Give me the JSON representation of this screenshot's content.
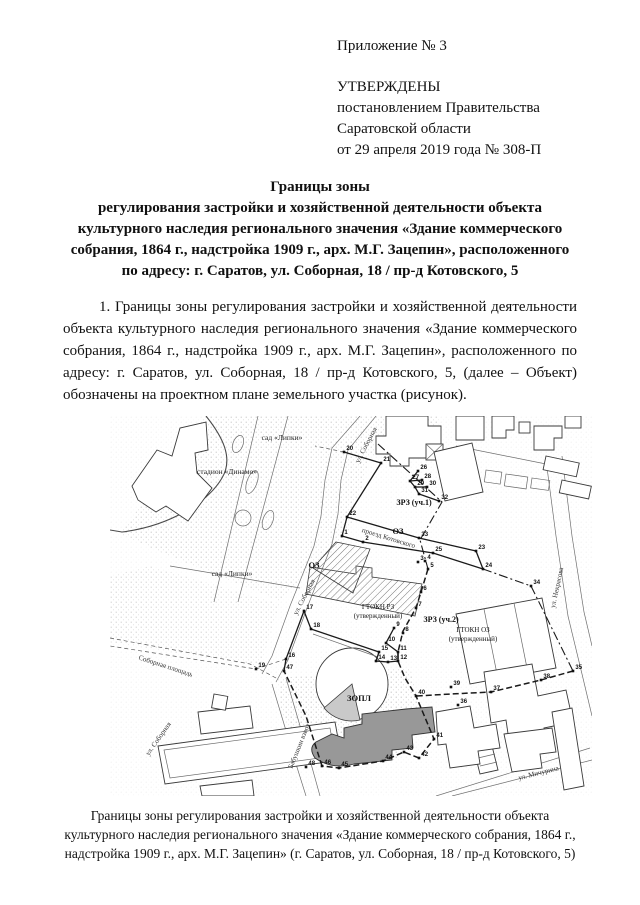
{
  "page": {
    "appendix": "Приложение № 3",
    "approval": [
      "УТВЕРЖДЕНЫ",
      "постановлением Правительства",
      "Саратовской области",
      "от 29 апреля 2019 года № 308-П"
    ],
    "title": [
      "Границы зоны",
      "регулирования застройки и хозяйственной деятельности объекта",
      "культурного наследия регионального значения «Здание коммерческого",
      "собрания, 1864 г., надстройка 1909 г., арх. М.Г. Зацепин», расположенного",
      "по адресу: г. Саратов, ул. Соборная, 18 / пр-д Котовского, 5"
    ],
    "paragraph": "1. Границы зоны регулирования застройки и хозяйственной деятельности объекта культурного наследия регионального значения «Здание коммерческого собрания, 1864 г., надстройка 1909 г., арх. М.Г. Зацепин», расположенного по адресу: г. Саратов, ул. Соборная, 18 / пр-д Котовского, 5, (далее – Объект) обозначены на проектном плане земельного участка (рисунок).",
    "caption": [
      "Границы зоны регулирования застройки и хозяйственной деятельности объекта",
      "культурного наследия регионального значения «Здание коммерческого собрания, 1864 г.,",
      "надстройка 1909 г., арх. М.Г. Зацепин» (г. Саратов, ул. Соборная, 18 / пр-д Котовского, 5)"
    ]
  },
  "map": {
    "labels": [
      {
        "t": "сад «Липки»",
        "x": 172,
        "y": 24,
        "r": 0,
        "k": "area"
      },
      {
        "t": "стадион «Динамо»",
        "x": 117,
        "y": 58,
        "r": 0,
        "k": "area"
      },
      {
        "t": "сад «Липки»",
        "x": 122,
        "y": 160,
        "r": 0,
        "k": "area"
      },
      {
        "t": "ул. Соборная",
        "x": 258,
        "y": 30,
        "r": -62,
        "k": "street"
      },
      {
        "t": "ОЗ",
        "x": 288,
        "y": 118,
        "r": 0,
        "k": "zone"
      },
      {
        "t": "ОЗ",
        "x": 204,
        "y": 152,
        "r": 0,
        "k": "zone"
      },
      {
        "t": "ЗРЗ (уч.1)",
        "x": 304,
        "y": 89,
        "r": 0,
        "k": "zone-bold"
      },
      {
        "t": "проезд Котовского",
        "x": 278,
        "y": 124,
        "r": 17,
        "k": "street"
      },
      {
        "t": "ул. Соборная",
        "x": 196,
        "y": 182,
        "r": -62,
        "k": "street"
      },
      {
        "t": "ГТОКН РЗ",
        "x": 268,
        "y": 193,
        "r": 0,
        "k": "zone-sm"
      },
      {
        "t": "(утвержденный)",
        "x": 268,
        "y": 202,
        "r": 0,
        "k": "zone-sm"
      },
      {
        "t": "ЗРЗ (уч.2)",
        "x": 331,
        "y": 206,
        "r": 0,
        "k": "zone-bold"
      },
      {
        "t": "ГТОКН ОЗ",
        "x": 363,
        "y": 216,
        "r": 0,
        "k": "zone-sm"
      },
      {
        "t": "(утвержденный)",
        "x": 363,
        "y": 225,
        "r": 0,
        "k": "zone-sm"
      },
      {
        "t": "ЗОПЛ",
        "x": 249,
        "y": 285,
        "r": 0,
        "k": "zone"
      },
      {
        "t": "Соборная площадь",
        "x": 55,
        "y": 252,
        "r": 18,
        "k": "street"
      },
      {
        "t": "ул. Соборная",
        "x": 50,
        "y": 324,
        "r": -55,
        "k": "street"
      },
      {
        "t": "Бабушкин взвоз",
        "x": 191,
        "y": 331,
        "r": -68,
        "k": "street"
      },
      {
        "t": "ул. Некрасова",
        "x": 449,
        "y": 172,
        "r": -78,
        "k": "street"
      },
      {
        "t": "ул. Мичурина",
        "x": 429,
        "y": 359,
        "r": -14,
        "k": "street"
      }
    ],
    "points": [
      {
        "n": "1",
        "x": 232,
        "y": 120
      },
      {
        "n": "2",
        "x": 253,
        "y": 126
      },
      {
        "n": "3",
        "x": 308,
        "y": 146
      },
      {
        "n": "4",
        "x": 315,
        "y": 145
      },
      {
        "n": "5",
        "x": 318,
        "y": 153
      },
      {
        "n": "6",
        "x": 311,
        "y": 176
      },
      {
        "n": "7",
        "x": 306,
        "y": 192
      },
      {
        "n": "8",
        "x": 293,
        "y": 217
      },
      {
        "n": "9",
        "x": 284,
        "y": 212
      },
      {
        "n": "10",
        "x": 276,
        "y": 227
      },
      {
        "n": "11",
        "x": 288,
        "y": 236
      },
      {
        "n": "12",
        "x": 288,
        "y": 245
      },
      {
        "n": "13",
        "x": 278,
        "y": 246
      },
      {
        "n": "14",
        "x": 266,
        "y": 245
      },
      {
        "n": "15",
        "x": 269,
        "y": 236
      },
      {
        "n": "16",
        "x": 176,
        "y": 243
      },
      {
        "n": "17",
        "x": 194,
        "y": 195
      },
      {
        "n": "18",
        "x": 201,
        "y": 213
      },
      {
        "n": "19",
        "x": 146,
        "y": 253
      },
      {
        "n": "20",
        "x": 234,
        "y": 36
      },
      {
        "n": "21",
        "x": 271,
        "y": 47
      },
      {
        "n": "22",
        "x": 237,
        "y": 101
      },
      {
        "n": "23",
        "x": 366,
        "y": 135
      },
      {
        "n": "24",
        "x": 373,
        "y": 153
      },
      {
        "n": "25",
        "x": 323,
        "y": 137
      },
      {
        "n": "26",
        "x": 308,
        "y": 55
      },
      {
        "n": "27",
        "x": 300,
        "y": 65
      },
      {
        "n": "28",
        "x": 312,
        "y": 64
      },
      {
        "n": "29",
        "x": 305,
        "y": 71
      },
      {
        "n": "30",
        "x": 317,
        "y": 71
      },
      {
        "n": "31",
        "x": 309,
        "y": 78
      },
      {
        "n": "32",
        "x": 329,
        "y": 85
      },
      {
        "n": "33",
        "x": 309,
        "y": 122
      },
      {
        "n": "34",
        "x": 421,
        "y": 170
      },
      {
        "n": "35",
        "x": 463,
        "y": 255
      },
      {
        "n": "36",
        "x": 348,
        "y": 289
      },
      {
        "n": "37",
        "x": 381,
        "y": 276
      },
      {
        "n": "38",
        "x": 431,
        "y": 264
      },
      {
        "n": "39",
        "x": 341,
        "y": 271
      },
      {
        "n": "40",
        "x": 306,
        "y": 280
      },
      {
        "n": "41",
        "x": 324,
        "y": 323
      },
      {
        "n": "42",
        "x": 309,
        "y": 342
      },
      {
        "n": "43",
        "x": 294,
        "y": 336
      },
      {
        "n": "44",
        "x": 273,
        "y": 345
      },
      {
        "n": "45",
        "x": 229,
        "y": 352
      },
      {
        "n": "46",
        "x": 212,
        "y": 350
      },
      {
        "n": "47",
        "x": 174,
        "y": 255
      },
      {
        "n": "48",
        "x": 196,
        "y": 351
      }
    ]
  }
}
